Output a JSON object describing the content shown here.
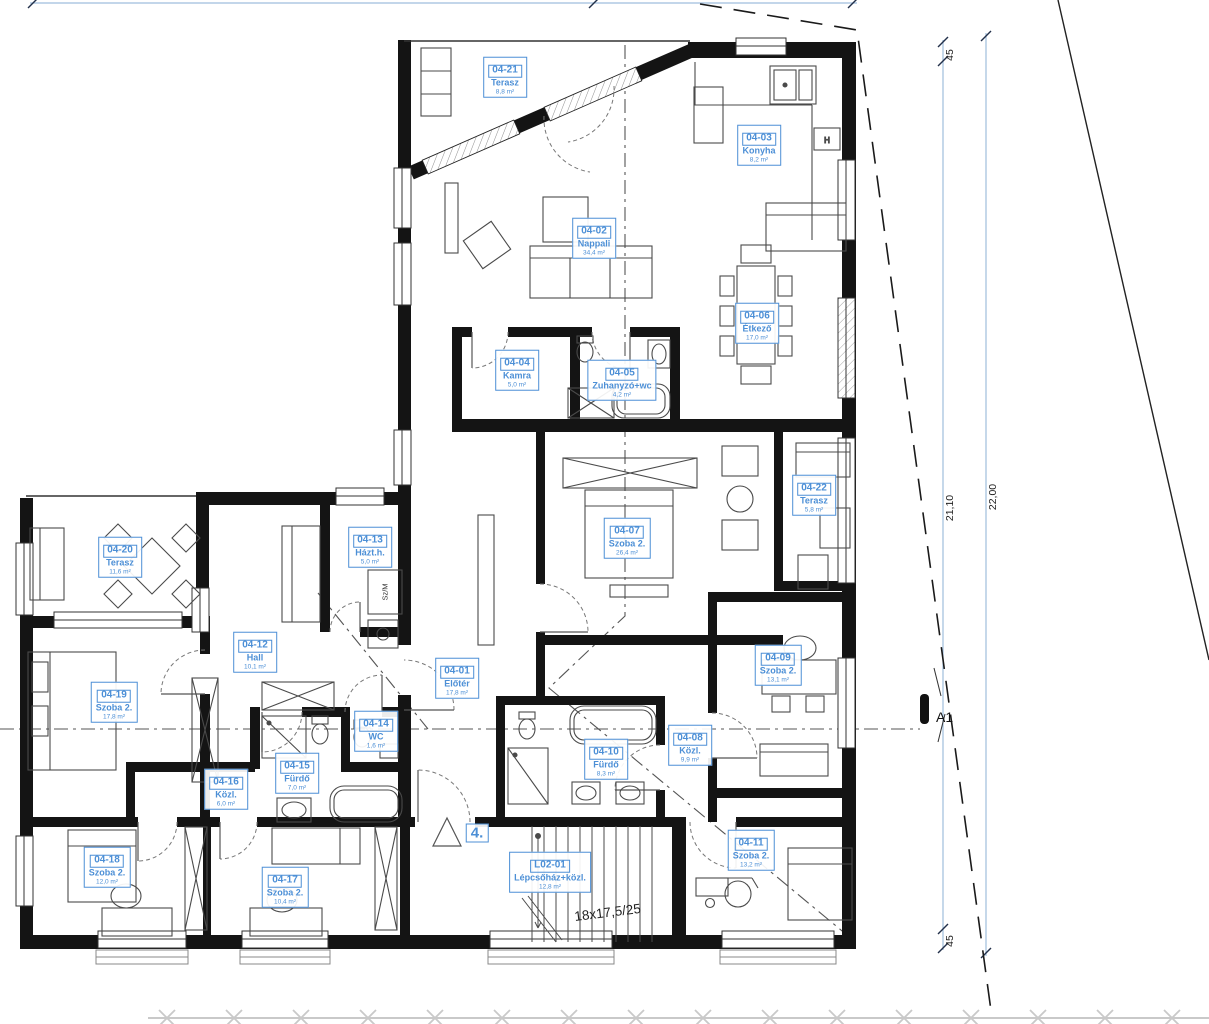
{
  "drawing": {
    "floor_marker": "4.",
    "stair_spec": "18x17,5/25",
    "section_marker": "A1",
    "washing_machine_label": "Sz/M",
    "kitchen_hood_label": "H"
  },
  "dimensions": {
    "wall_top": "45",
    "inner_height": "21,10",
    "outer_height": "22,00",
    "wall_bottom": "45"
  },
  "colors": {
    "label_blue": "#4c8fd6",
    "dimension_blue": "#9fbddd",
    "wall_black": "#141414",
    "furniture_gray": "#4a4a4a",
    "fence_gray": "#c9c9c9",
    "boundary_black": "#1a1a1a"
  },
  "rooms": [
    {
      "id": "04-21",
      "name": "Terasz",
      "area": "8,8 m²"
    },
    {
      "id": "04-03",
      "name": "Konyha",
      "area": "8,2 m²"
    },
    {
      "id": "04-02",
      "name": "Nappali",
      "area": "34,4 m²"
    },
    {
      "id": "04-06",
      "name": "Étkező",
      "area": "17,0 m²"
    },
    {
      "id": "04-04",
      "name": "Kamra",
      "area": "5,0 m²"
    },
    {
      "id": "04-05",
      "name": "Zuhanyzó+wc",
      "area": "4,2 m²"
    },
    {
      "id": "04-07",
      "name": "Szoba 2.",
      "area": "26,4 m²"
    },
    {
      "id": "04-22",
      "name": "Terasz",
      "area": "5,8 m²"
    },
    {
      "id": "04-20",
      "name": "Terasz",
      "area": "11,6 m²"
    },
    {
      "id": "04-13",
      "name": "Házt.h.",
      "area": "5,0 m²"
    },
    {
      "id": "04-12",
      "name": "Hall",
      "area": "10,1 m²"
    },
    {
      "id": "04-19",
      "name": "Szoba 2.",
      "area": "17,8 m²"
    },
    {
      "id": "04-01",
      "name": "Előtér",
      "area": "17,8 m²"
    },
    {
      "id": "04-14",
      "name": "WC",
      "area": "1,6 m²"
    },
    {
      "id": "04-15",
      "name": "Fürdő",
      "area": "7,0 m²"
    },
    {
      "id": "04-16",
      "name": "Közl.",
      "area": "6,0 m²"
    },
    {
      "id": "04-10",
      "name": "Fürdő",
      "area": "8,3 m²"
    },
    {
      "id": "04-08",
      "name": "Közl.",
      "area": "9,9 m²"
    },
    {
      "id": "04-09",
      "name": "Szoba 2.",
      "area": "13,1 m²"
    },
    {
      "id": "04-11",
      "name": "Szoba 2.",
      "area": "13,2 m²"
    },
    {
      "id": "04-18",
      "name": "Szoba 2.",
      "area": "12,0 m²"
    },
    {
      "id": "04-17",
      "name": "Szoba 2.",
      "area": "10,4 m²"
    },
    {
      "id": "L02-01",
      "name": "Lépcsőház+közl.",
      "area": "12,8 m²"
    }
  ]
}
